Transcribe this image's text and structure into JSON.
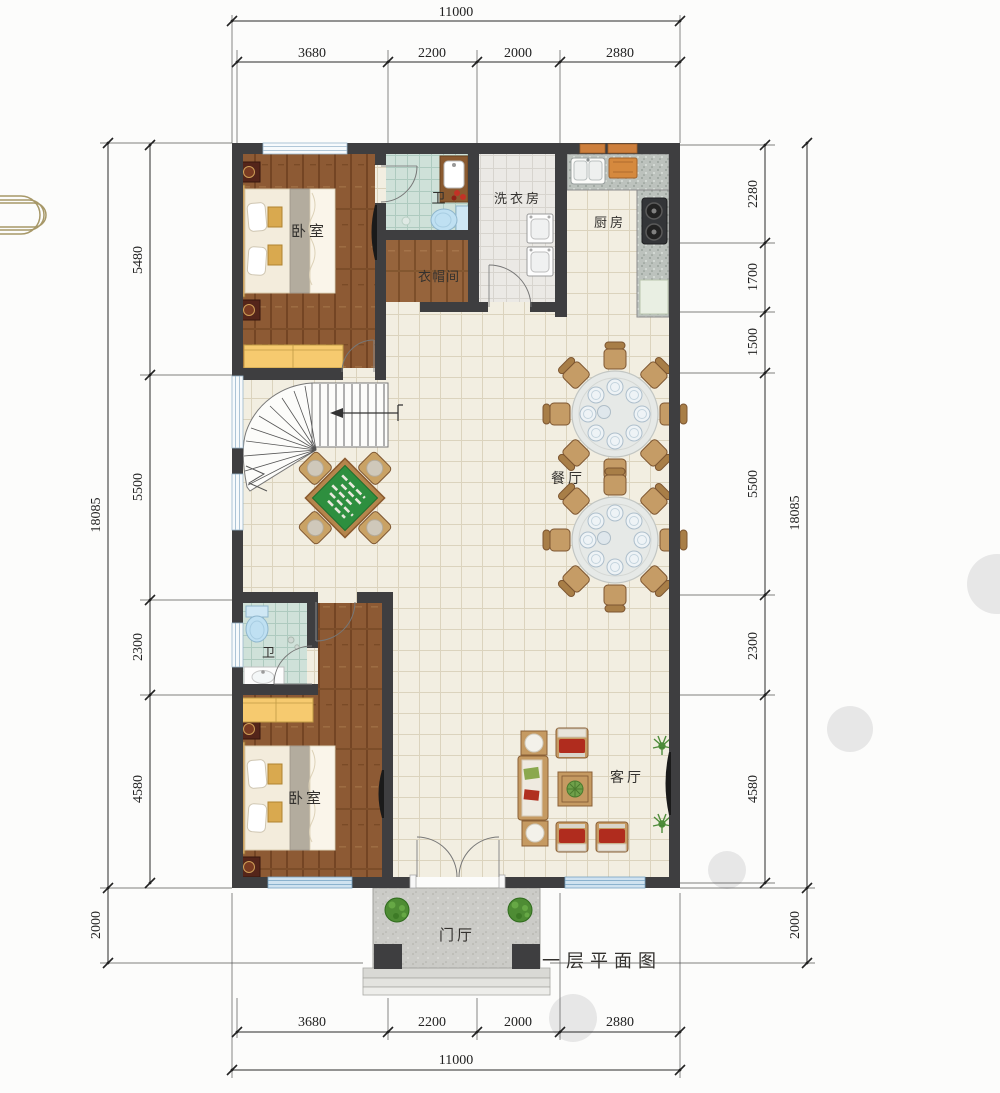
{
  "caption": "一层平面图",
  "rooms": {
    "bedroom_top": "卧室",
    "bath_top": "卫",
    "laundry": "洗衣房",
    "kitchen": "厨房",
    "cloakroom": "衣帽间",
    "dining": "餐厅",
    "bath_bottom": "卫",
    "bedroom_bottom": "卧室",
    "living": "客厅",
    "foyer": "门厅"
  },
  "dimensions": {
    "top": {
      "total": "11000",
      "segments": [
        "3680",
        "2200",
        "2000",
        "2880"
      ]
    },
    "bottom": {
      "total": "11000",
      "segments": [
        "3680",
        "2200",
        "2000",
        "2880"
      ]
    },
    "left": {
      "total": "18085",
      "segments": [
        "5480",
        "5500",
        "2300",
        "4580"
      ],
      "porch": "2000"
    },
    "right": {
      "total": "18085",
      "segments": [
        "2280",
        "1700",
        "1500",
        "5500",
        "2300",
        "4580"
      ],
      "porch": "2000"
    }
  },
  "colors": {
    "wall": "#3e3e40",
    "wood_floor": "#8d5a34",
    "tile_floor": "#f2eee1",
    "bath_tile": "#cfe1d9",
    "laundry_tile": "#ebe9e5",
    "wardrobe": "#f6ca6f",
    "mahjong_table": "#2e8f3f",
    "sofa_cushion": "#b02c1e",
    "counter": "#bcc2bd",
    "window_blue": "#cfe2f0",
    "dimension_ink": "#2a2a2a"
  }
}
